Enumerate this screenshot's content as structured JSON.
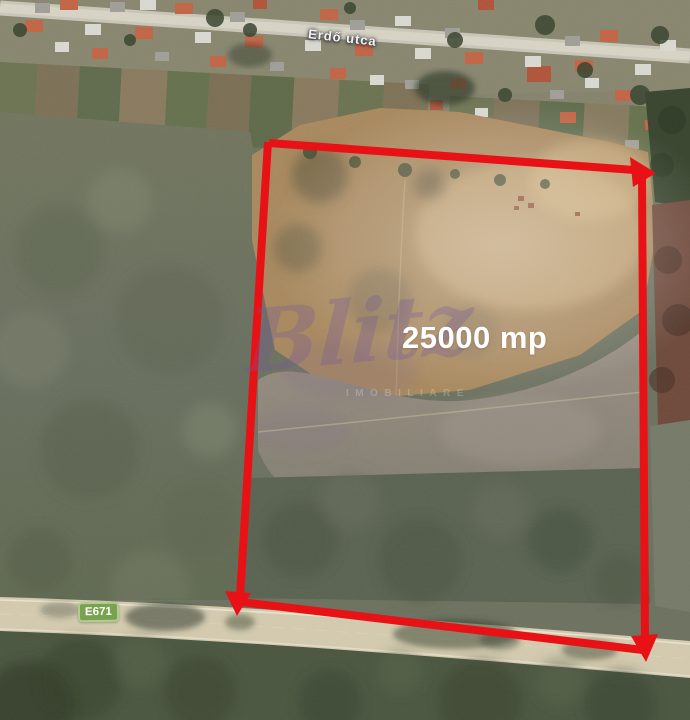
{
  "labels": {
    "street": "Erdő utca",
    "area": "25000 mp",
    "route": "E671"
  },
  "watermark": {
    "brand": "Blitz",
    "subtext": "IMOBILIARE"
  },
  "colors": {
    "outline_red": "#e81216",
    "badge_fill": "#77a24e",
    "badge_border": "#b2cc93",
    "badge_text": "#ffffff",
    "label_text": "#ffffff",
    "watermark_purple": "#74569c",
    "road_fill": "#d2c9ae",
    "field_green": "#6d7260",
    "plot_tan": "#a8895f"
  }
}
